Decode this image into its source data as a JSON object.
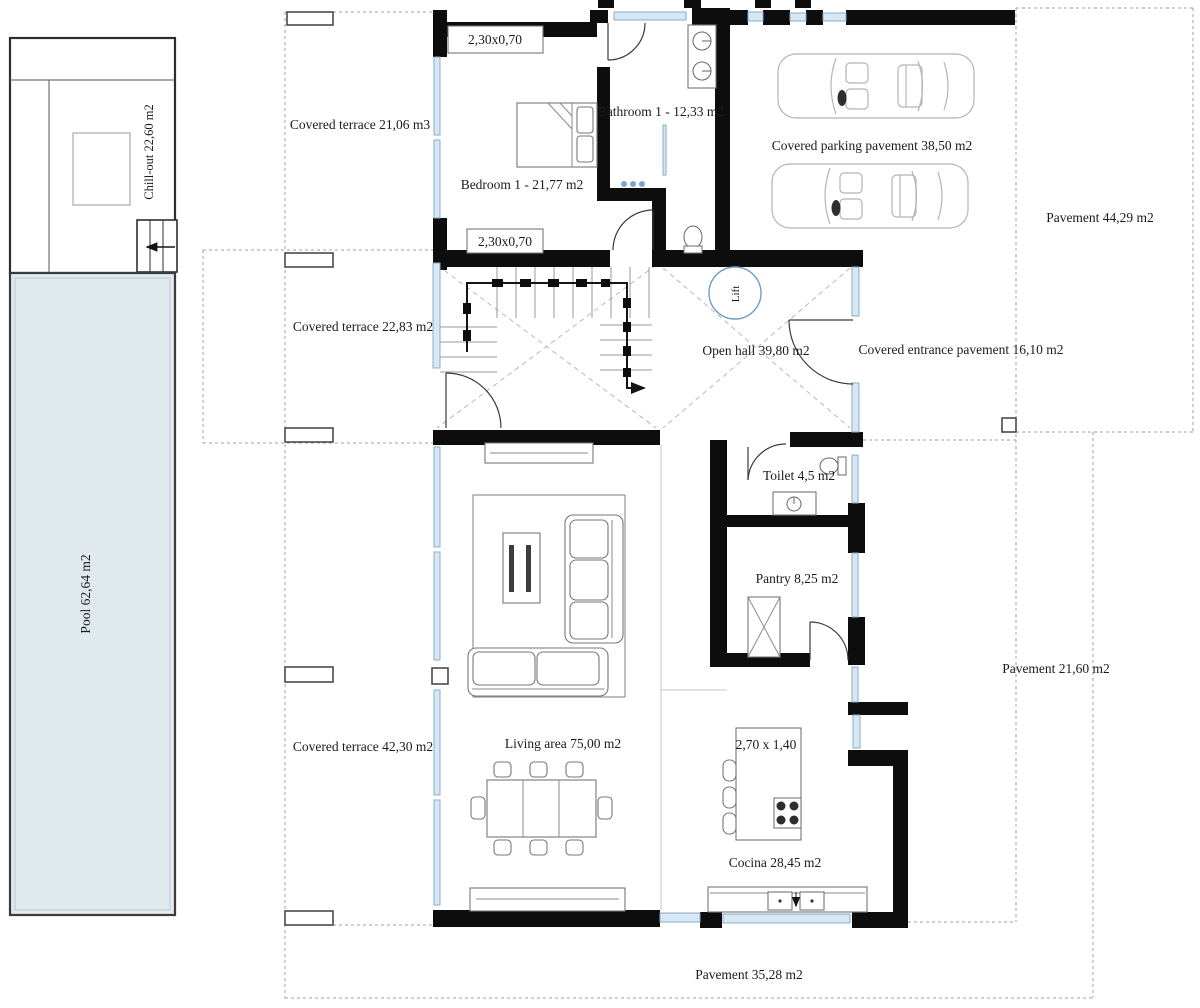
{
  "labels": {
    "chill_out": "Chill-out 22,60 m2",
    "pool": "Pool 62,64 m2",
    "covered_terrace_top": "Covered terrace 21,06 m3",
    "covered_terrace_mid": "Covered terrace 22,83 m2",
    "covered_terrace_bottom": "Covered terrace 42,30 m2",
    "window_dim_top": "2,30x0,70",
    "window_dim_bottom": "2,30x0,70",
    "bedroom1": "Bedroom 1 -  21,77 m2",
    "bathroom1": "Bathroom 1 -  12,33 m2",
    "parking": "Covered parking pavement 38,50 m2",
    "pavement_ne": "Pavement 44,29 m2",
    "open_hall": "Open hall 39,80 m2",
    "lift": "Lift",
    "entrance": "Covered entrance pavement 16,10 m2",
    "toilet": "Toilet 4,5 m2",
    "pantry": "Pantry 8,25 m2",
    "living": "Living area 75,00 m2",
    "island_dim": "2,70 x 1,40",
    "cocina": "Cocina 28,45 m2",
    "pavement_e": "Pavement 21,60 m2",
    "pavement_s": "Pavement 35,28 m2"
  },
  "colors": {
    "wall": "#0d0d0d",
    "window_fill": "#d9e7f3",
    "window_border": "#85aecd",
    "pool_fill": "#dfe9ee",
    "dashed_line": "#9aa0a4",
    "text": "#1b1b1b",
    "lift_circle": "#6f9dc9"
  }
}
